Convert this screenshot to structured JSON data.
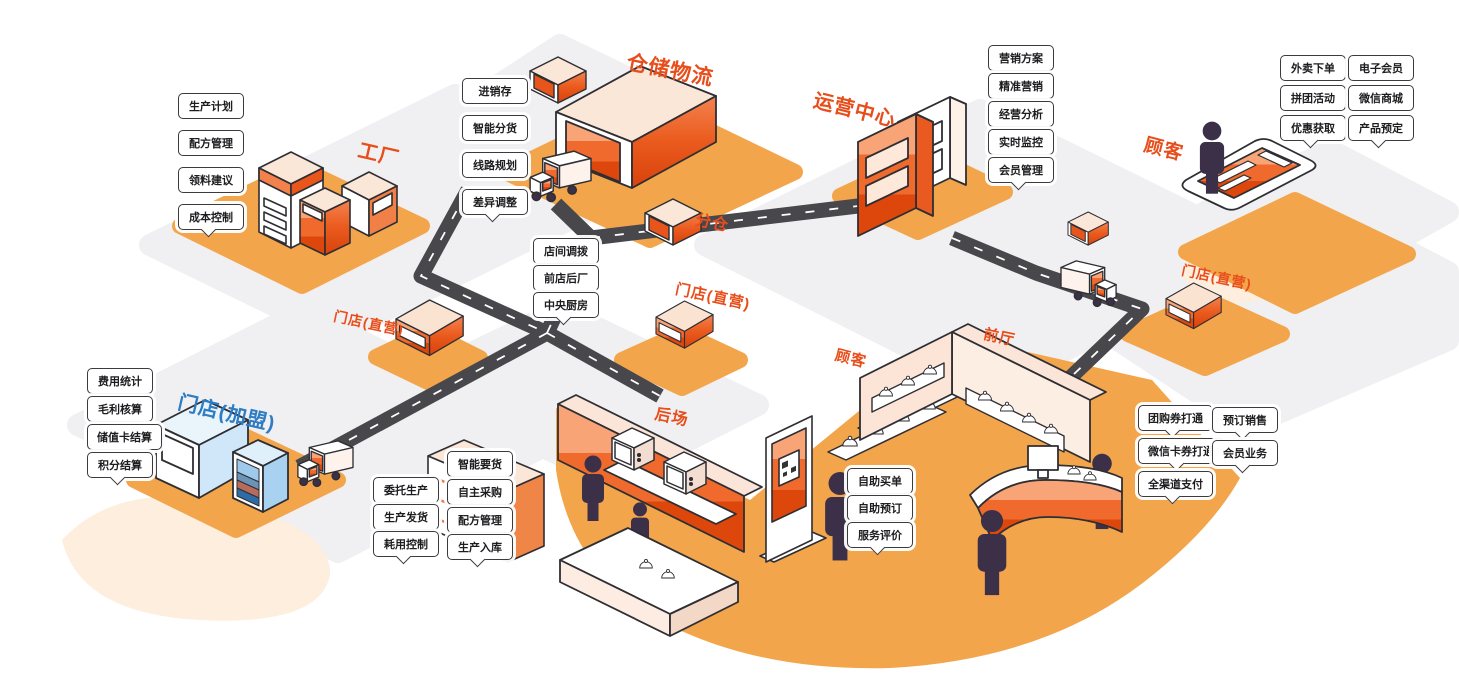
{
  "areas": {
    "factory": {
      "title": "工厂",
      "callouts": [
        "生产计划",
        "配方管理",
        "领料建议",
        "成本控制"
      ]
    },
    "warehouse": {
      "title": "仓储物流",
      "callouts": [
        "进销存",
        "智能分货",
        "线路规划",
        "差异调整"
      ]
    },
    "sub_warehouse": {
      "title": "分仓"
    },
    "logistics_hub": {
      "callouts": [
        "店间调拨",
        "前店后厂",
        "中央厨房"
      ]
    },
    "operations_center": {
      "title": "运营中心",
      "callouts": [
        "营销方案",
        "精准营销",
        "经营分析",
        "实时监控",
        "会员管理"
      ]
    },
    "customer_online": {
      "title": "顾客",
      "callouts_col1": [
        "外卖下单",
        "拼团活动",
        "优惠获取"
      ],
      "callouts_col2": [
        "电子会员",
        "微信商城",
        "产品预定"
      ]
    },
    "store_direct_left": {
      "title": "门店(直营)"
    },
    "store_direct_mid": {
      "title": "门店(直营)"
    },
    "store_direct_right": {
      "title": "门店(直营)"
    },
    "store_franchise": {
      "title": "门店(加盟)",
      "callouts": [
        "费用统计",
        "毛利核算",
        "储值卡结算",
        "积分结算"
      ]
    },
    "back_area": {
      "title": "后场",
      "callouts_col1": [
        "委托生产",
        "生产发货",
        "耗用控制"
      ],
      "callouts_col2": [
        "智能要货",
        "自主采购",
        "配方管理",
        "生产入库"
      ]
    },
    "customer_instore": {
      "title": "顾客",
      "callouts": [
        "自助买单",
        "自助预订",
        "服务评价"
      ]
    },
    "front_hall": {
      "title": "前厅",
      "callouts_col1": [
        "团购券打通",
        "微信卡券打通",
        "全渠道支付"
      ],
      "callouts_col2": [
        "预订销售",
        "会员业务"
      ]
    }
  },
  "colors": {
    "accent_orange": "#e84e1b",
    "accent_blue": "#2e7cc3",
    "road": "#47474c",
    "ground_orange": "#f3a54b",
    "platform_gray": "#f0f0f2",
    "platform_peach": "#fdeede",
    "figure": "#3b3048"
  }
}
